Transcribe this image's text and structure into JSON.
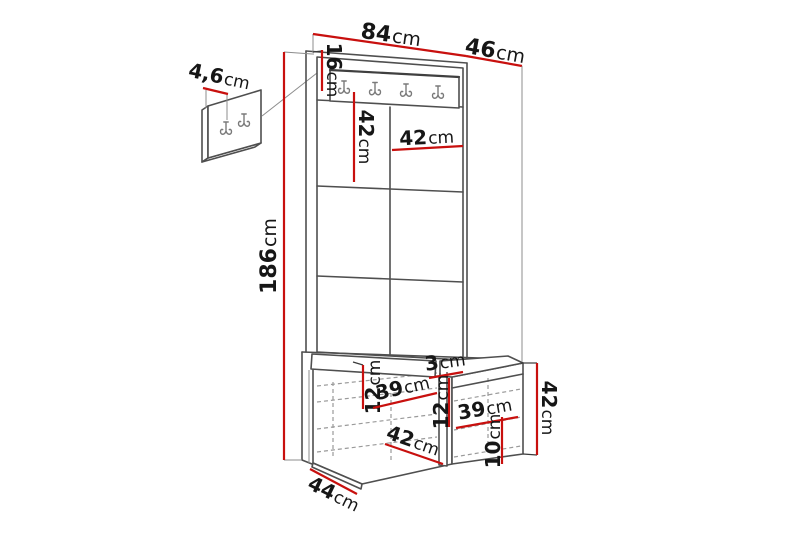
{
  "meta": {
    "description": "Dimension diagram of a hallway wardrobe set: wall hook panel detail, tall panel with hook rail and upholstered tiles, and a storage bench",
    "accent_color": "#c8100e",
    "line_color": "#4f4f4f",
    "background_color": "#ffffff"
  },
  "icons": {
    "coat_hook": "coat-hook-icon"
  },
  "dimensions": {
    "panel_width": {
      "num": "84",
      "unit": "cm"
    },
    "top_depth": {
      "num": "46",
      "unit": "cm"
    },
    "total_height": {
      "num": "186",
      "unit": "cm"
    },
    "rail_height": {
      "num": "16",
      "unit": "cm"
    },
    "tile_height": {
      "num": "42",
      "unit": "cm"
    },
    "tile_width": {
      "num": "42",
      "unit": "cm"
    },
    "hook_panel_depth": {
      "num": "4,6",
      "unit": "cm"
    },
    "left_opening_height": {
      "num": "12",
      "unit": "cm"
    },
    "left_opening_width": {
      "num": "39",
      "unit": "cm"
    },
    "divider_width": {
      "num": "3",
      "unit": "cm"
    },
    "mid_opening_height": {
      "num": "12",
      "unit": "cm"
    },
    "right_opening_width": {
      "num": "39",
      "unit": "cm"
    },
    "bottom_opening_width": {
      "num": "42",
      "unit": "cm"
    },
    "plinth_height": {
      "num": "10",
      "unit": "cm"
    },
    "bench_depth": {
      "num": "44",
      "unit": "cm"
    },
    "bench_height": {
      "num": "42",
      "unit": "cm"
    }
  }
}
